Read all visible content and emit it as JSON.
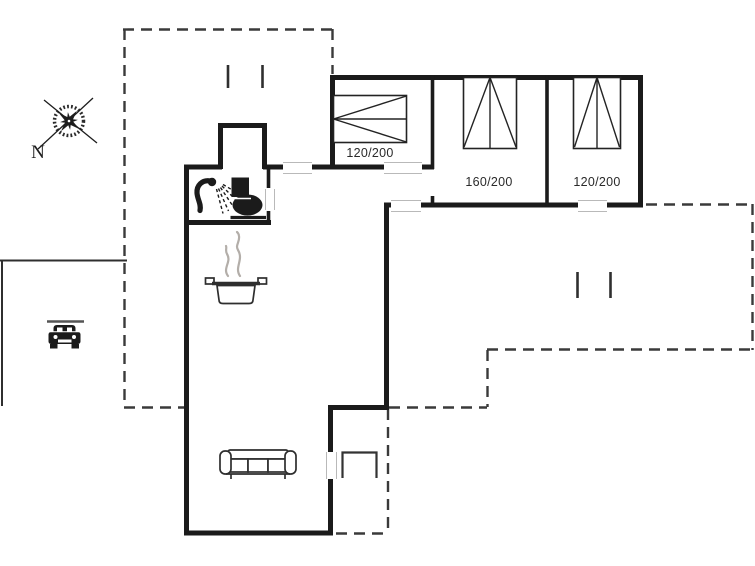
{
  "plan": {
    "compass": {
      "north_label": "N"
    },
    "beds": [
      {
        "label": "120/200"
      },
      {
        "label": "160/200"
      },
      {
        "label": "120/200"
      }
    ],
    "icons": [
      "compass-rose-icon",
      "car-icon",
      "shower-icon",
      "toilet-icon",
      "cooking-pot-icon",
      "steam-icon",
      "sofa-icon",
      "bed-symbol",
      "entry-step",
      "door-opening",
      "window-opening"
    ],
    "colors": {
      "background": "#ffffff",
      "wall": "#1b1b1b",
      "dash": "#3a3a3a",
      "thin_line": "#2f2f2f",
      "furniture": "#2e2e2e",
      "steam": "#b3aea9",
      "label_text": "#2a2a2a",
      "opening_border": "#b9b9b9"
    }
  }
}
